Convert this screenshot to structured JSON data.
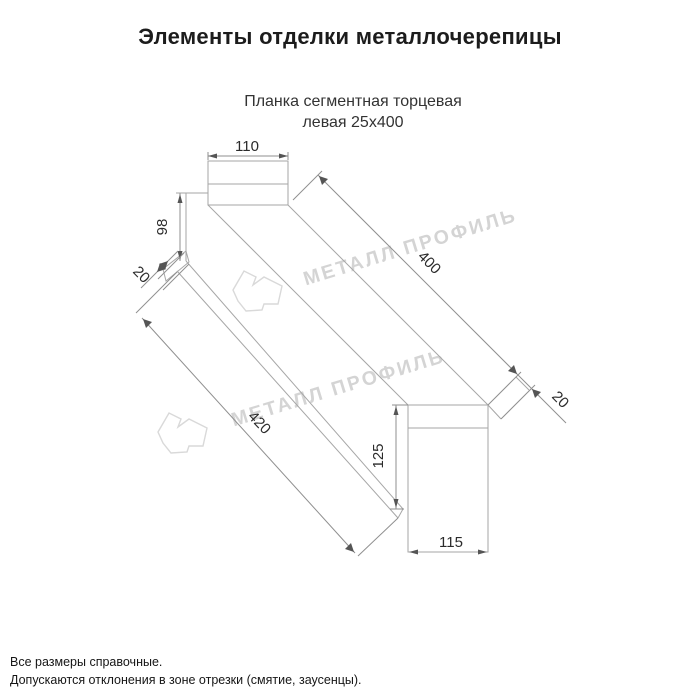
{
  "header": {
    "title": "Элементы отделки металлочерепицы",
    "subtitle_line1": "Планка сегментная торцевая",
    "subtitle_line2": "левая 25х400"
  },
  "drawing": {
    "type": "technical-dimension-drawing",
    "line_color": "#a6a6a6",
    "dim_text_color": "#2b2b2b",
    "dimensions": {
      "top_width": "110",
      "left_height": "98",
      "left_hem": "20",
      "top_length": "400",
      "bottom_length": "420",
      "right_hem": "20",
      "right_height": "125",
      "bottom_width": "115"
    },
    "watermark": {
      "text": "МЕТАЛЛ ПРОФИЛЬ",
      "color": "#d4d4d4"
    }
  },
  "footer": {
    "note_line1": "Все размеры справочные.",
    "note_line2": "Допускаются отклонения в зоне отрезки (смятие, заусенцы)."
  }
}
